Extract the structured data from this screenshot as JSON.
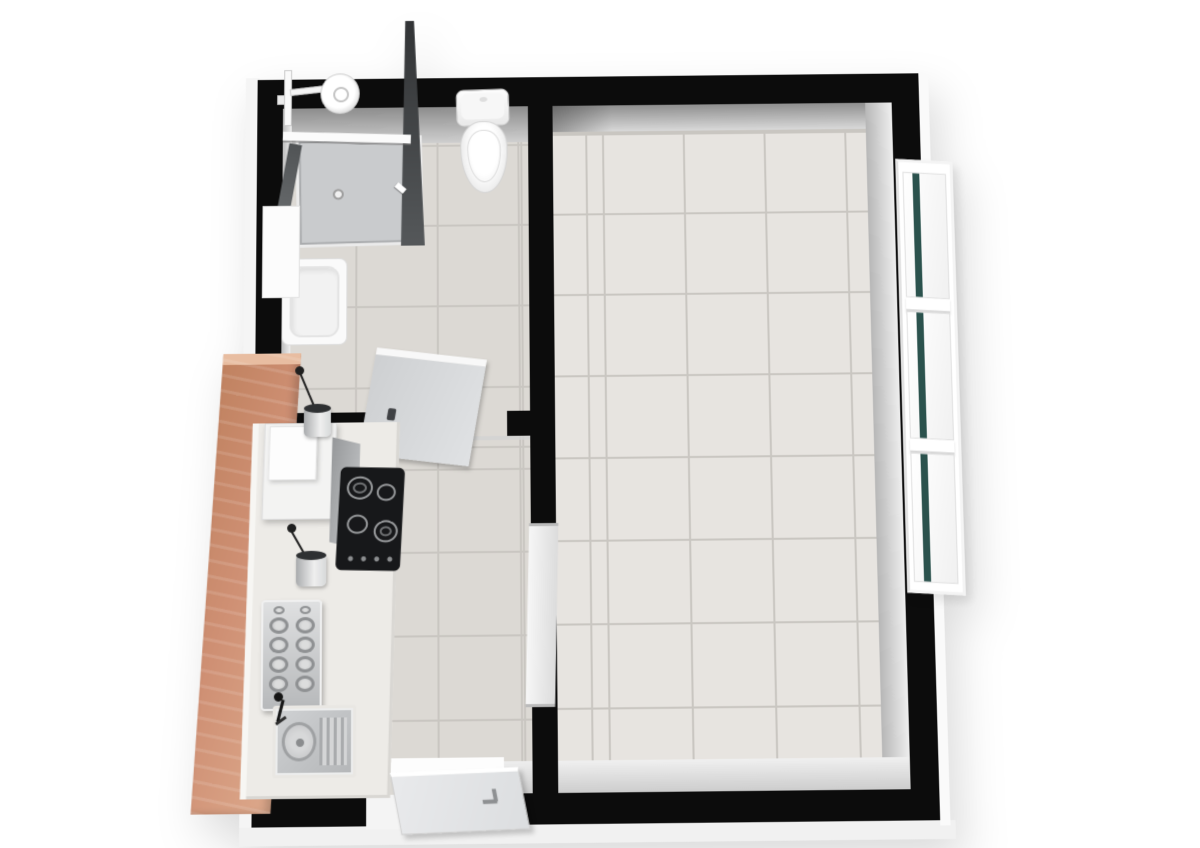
{
  "scene": {
    "type": "3d-floor-plan-render",
    "description": "Top-down 3D rendering of a small apartment floor plan on a white background",
    "rooms": [
      {
        "id": "bathroom",
        "label": "Bathroom",
        "position": "top-left",
        "fixtures": [
          "corner shower enclosure with glass walls",
          "wall-mounted shower head",
          "toilet",
          "washbasin with vanity cabinet",
          "open interior door"
        ]
      },
      {
        "id": "kitchen",
        "label": "Kitchen",
        "position": "bottom-left",
        "fixtures": [
          "terracotta accent wall",
          "kitchen counter",
          "range hood with chimney",
          "black cooktop with four burners",
          "two pendant lamps",
          "dish rack",
          "stainless sink with drainboard",
          "black faucet",
          "open entry door in bottom wall"
        ]
      },
      {
        "id": "living-room",
        "label": "Living room",
        "position": "right",
        "fixtures": [
          "triple window bank on right wall",
          "closed connecting door in dividing wall"
        ]
      }
    ]
  },
  "colors": {
    "page-bg": "#ffffff",
    "wall": "#0c0c0c",
    "floor-tile-small": "#dcd9d4",
    "floor-tile-large": "#e7e4e0",
    "grout": "#c9c6c1",
    "counter": "#edebe7",
    "accent-wall": "#cf9074",
    "accent-wall-light": "#e8bda1",
    "window-glass": "#2b524d",
    "cooktop": "#17181a",
    "fixture-white": "#fafafa",
    "steel": "#c3c5c7",
    "door-panel": "#d5d7d9"
  },
  "window_bank": {
    "panes": 3
  },
  "cooktop": {
    "burners": 4
  },
  "dish_rack": {
    "small_items": 2,
    "large_items": 8
  }
}
